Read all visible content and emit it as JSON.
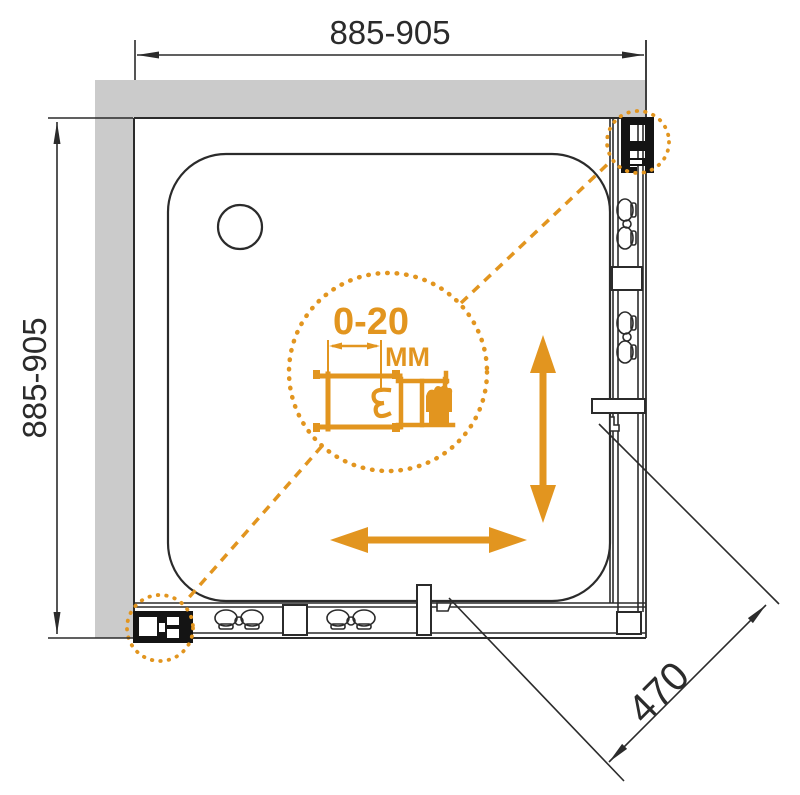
{
  "drawing": {
    "dim_top": "885-905",
    "dim_left": "885-905",
    "dim_diagonal": "470",
    "detail_range": "0-20",
    "detail_unit": "MM"
  },
  "colors": {
    "accent_orange": "#e2951f",
    "line_black": "#2b2b2b",
    "wall_gray": "#cbcbcb",
    "background": "#ffffff"
  },
  "icons": {
    "detail_callout": "magnified-detail-circle",
    "slide_arrows": "double-headed-slide-arrows"
  }
}
